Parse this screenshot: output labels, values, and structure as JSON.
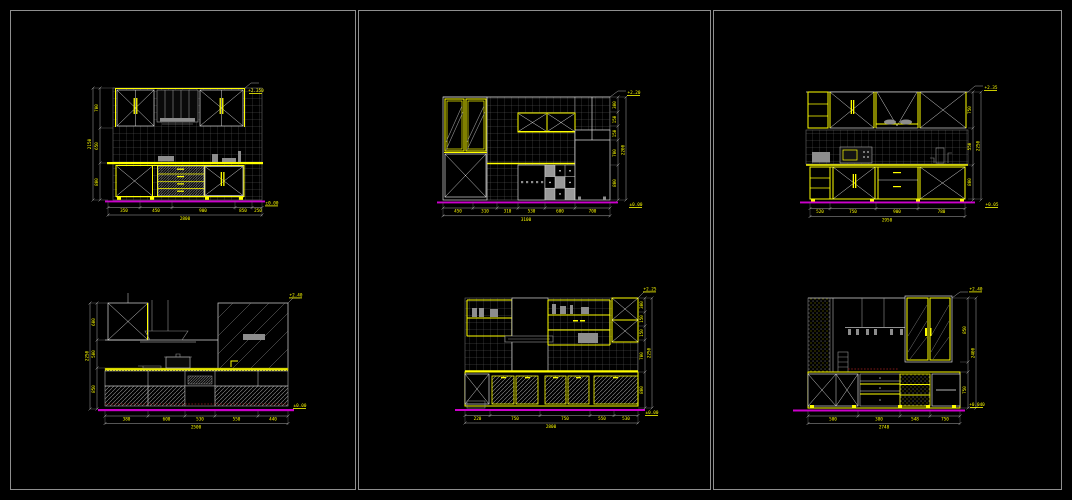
{
  "app": {
    "description": "CAD model space with three tiled viewports showing six kitchen elevation drawings"
  },
  "colors": {
    "background": "#000000",
    "viewport_border": "#8f8f8f",
    "line_white": "#d9d9d9",
    "line_gray": "#909090",
    "tile_grid": "#5f5f5f",
    "accent_yellow": "#ffff00",
    "baseline_magenta": "#cc00cc",
    "hatch_gray": "#9a9a9a",
    "red_dashed": "#a82222"
  },
  "d1": {
    "bottom_dims": [
      "350",
      "450",
      "900",
      "850",
      "250"
    ],
    "bottom_total": "2800",
    "side_dims": [
      "700",
      "650",
      "800"
    ],
    "side_total": "2150",
    "top_mark": "+2.350",
    "base_mark": "±0.00"
  },
  "d2": {
    "bottom_dims": [
      "450",
      "310",
      "310",
      "530",
      "600",
      "700"
    ],
    "bottom_total": "3100",
    "side_dims": [
      "300",
      "150",
      "150",
      "700",
      "800"
    ],
    "side_total": "2200",
    "top_mark": "+2.20",
    "base_mark": "±0.00"
  },
  "d3": {
    "bottom_dims": [
      "520",
      "750",
      "900",
      "780"
    ],
    "bottom_total": "2950",
    "side_dims": [
      "750",
      "550",
      "800"
    ],
    "side_total": "2250",
    "top_mark": "+2.35",
    "base_mark": "+0.05"
  },
  "d4": {
    "bottom_dims": [
      "380",
      "600",
      "530",
      "550",
      "440"
    ],
    "bottom_total": "2500",
    "side_dims": [
      "600",
      "500",
      "850"
    ],
    "side_total": "2250",
    "top_mark": "+2.40",
    "base_mark": "±0.00"
  },
  "d5": {
    "bottom_dims": [
      "220",
      "750",
      "750",
      "550",
      "530"
    ],
    "bottom_total": "2800",
    "side_dims": [
      "300",
      "150",
      "150",
      "700",
      "800"
    ],
    "side_total": "2250",
    "top_mark": "+2.25",
    "base_mark": "±0.00"
  },
  "d6": {
    "bottom_dims": [
      "500",
      "380",
      "548",
      "750"
    ],
    "bottom_total": "2748",
    "side_dims": [
      "850",
      "750"
    ],
    "side_total": "2400",
    "top_mark": "+2.40",
    "base_mark": "+0.040"
  }
}
